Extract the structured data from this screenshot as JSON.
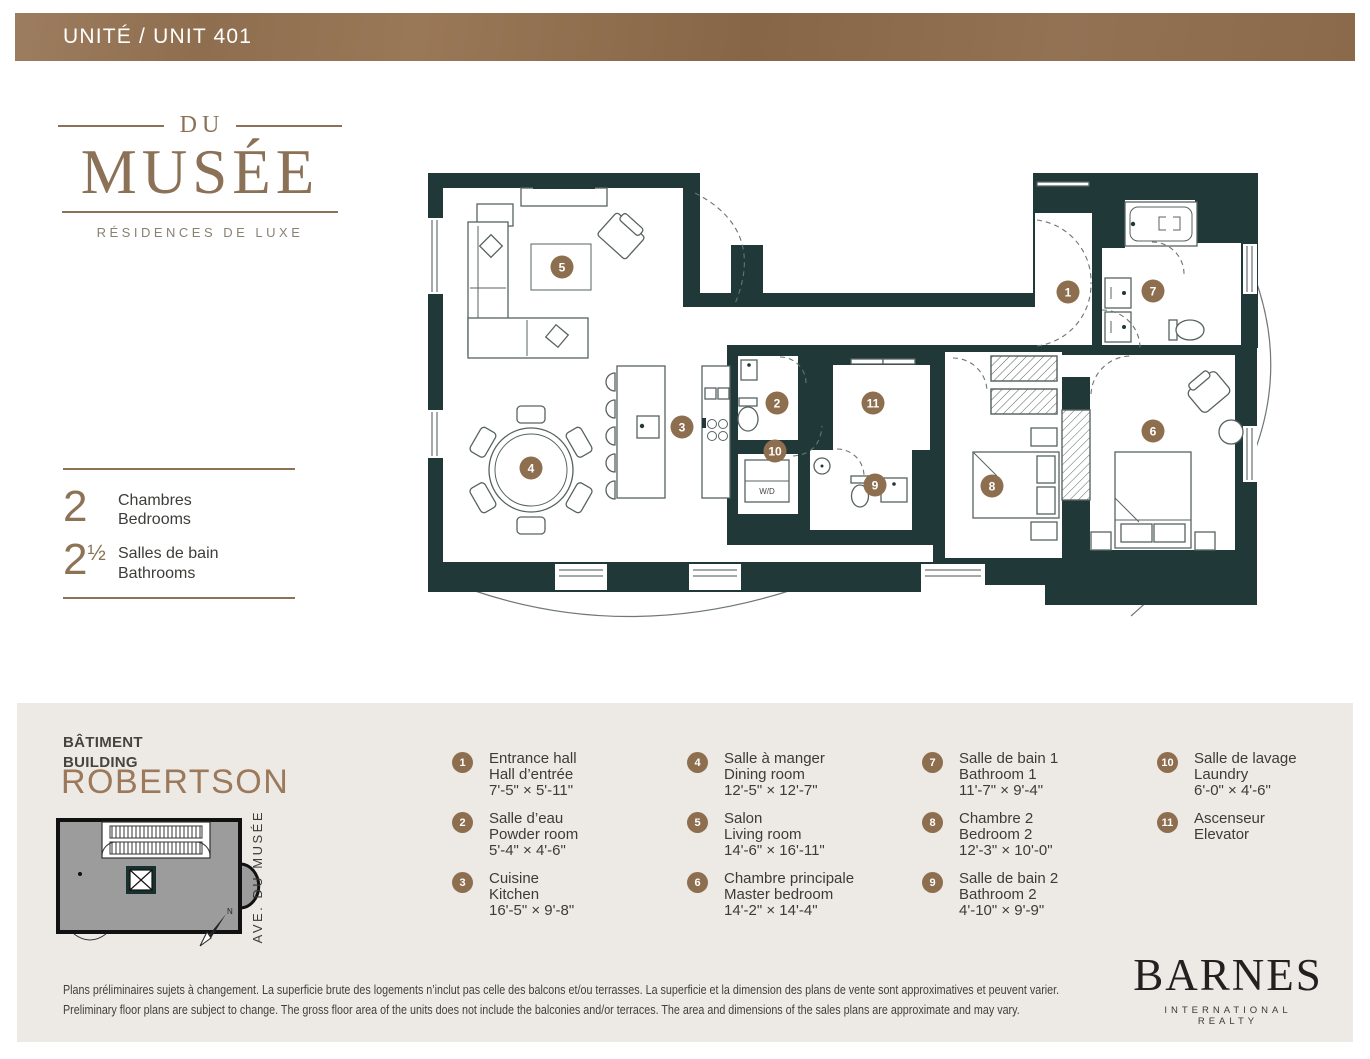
{
  "header": {
    "title": "UNITÉ / UNIT 401"
  },
  "brand": {
    "prefix": "DU",
    "name": "MUSÉE",
    "tagline": "RÉSIDENCES DE LUXE"
  },
  "stats": [
    {
      "value": "2",
      "frac": "",
      "fr": "Chambres",
      "en": "Bedrooms"
    },
    {
      "value": "2",
      "frac": "½",
      "fr": "Salles de bain",
      "en": "Bathrooms"
    }
  ],
  "plan": {
    "room_markers": [
      {
        "num": "1",
        "x": 643,
        "y": 132
      },
      {
        "num": "2",
        "x": 352,
        "y": 243
      },
      {
        "num": "3",
        "x": 257,
        "y": 267
      },
      {
        "num": "4",
        "x": 106,
        "y": 308
      },
      {
        "num": "5",
        "x": 137,
        "y": 107
      },
      {
        "num": "6",
        "x": 728,
        "y": 271
      },
      {
        "num": "7",
        "x": 728,
        "y": 131
      },
      {
        "num": "8",
        "x": 567,
        "y": 326
      },
      {
        "num": "9",
        "x": 450,
        "y": 325
      },
      {
        "num": "10",
        "x": 350,
        "y": 291
      },
      {
        "num": "11",
        "x": 448,
        "y": 243
      }
    ],
    "laundry_unit_label": "W/D"
  },
  "footer": {
    "building": {
      "label_fr": "BÂTIMENT",
      "label_en": "BUILDING",
      "name": "ROBERTSON",
      "street": "AVE. DU MUSÉE",
      "north": "N"
    },
    "legend": {
      "columns": [
        [
          {
            "num": "1",
            "lines": [
              "Entrance hall",
              "Hall d’entrée",
              "7'-5\" × 5'-11\""
            ]
          },
          {
            "num": "2",
            "lines": [
              "Salle d’eau",
              "Powder room",
              "5'-4\" × 4'-6\""
            ]
          },
          {
            "num": "3",
            "lines": [
              "Cuisine",
              "Kitchen",
              "16'-5\" × 9'-8\""
            ]
          }
        ],
        [
          {
            "num": "4",
            "lines": [
              "Salle à manger",
              "Dining room",
              "12'-5\" × 12'-7\""
            ]
          },
          {
            "num": "5",
            "lines": [
              "Salon",
              "Living room",
              "14'-6\" × 16'-11\""
            ]
          },
          {
            "num": "6",
            "lines": [
              "Chambre principale",
              "Master bedroom",
              "14'-2\" × 14'-4\""
            ]
          }
        ],
        [
          {
            "num": "7",
            "lines": [
              "Salle de bain 1",
              "Bathroom 1",
              "11'-7\" × 9'-4\""
            ]
          },
          {
            "num": "8",
            "lines": [
              "Chambre 2",
              "Bedroom 2",
              "12'-3\" × 10'-0\""
            ]
          },
          {
            "num": "9",
            "lines": [
              "Salle de bain 2",
              "Bathroom 2",
              "4'-10\" × 9'-9\""
            ]
          }
        ],
        [
          {
            "num": "10",
            "lines": [
              "Salle de lavage",
              "Laundry",
              "6'-0\" × 4'-6\""
            ]
          },
          {
            "num": "11",
            "lines": [
              "Ascenseur",
              "Elevator"
            ]
          }
        ]
      ]
    },
    "disclaimer": {
      "fr": "Plans préliminaires sujets à changement. La superficie brute des logements n’inclut pas celle des balcons et/ou terrasses. La superficie et la dimension des plans de vente sont approximatives et peuvent varier.",
      "en": "Preliminary floor plans are subject to change. The gross floor area of the units does not include the balconies and/or terraces. The area and dimensions of the sales plans are approximate and may vary."
    },
    "brand_logo": {
      "name": "BARNES",
      "subtitle": "INTERNATIONAL REALTY"
    }
  },
  "colors": {
    "band_brown": "#8a6a4a",
    "wall_dark": "#203837",
    "marker_brown": "#8d6e4e",
    "logo_brown": "#8b7156",
    "panel_beige": "#edeae6",
    "site_gray": "#9c9c9c"
  }
}
